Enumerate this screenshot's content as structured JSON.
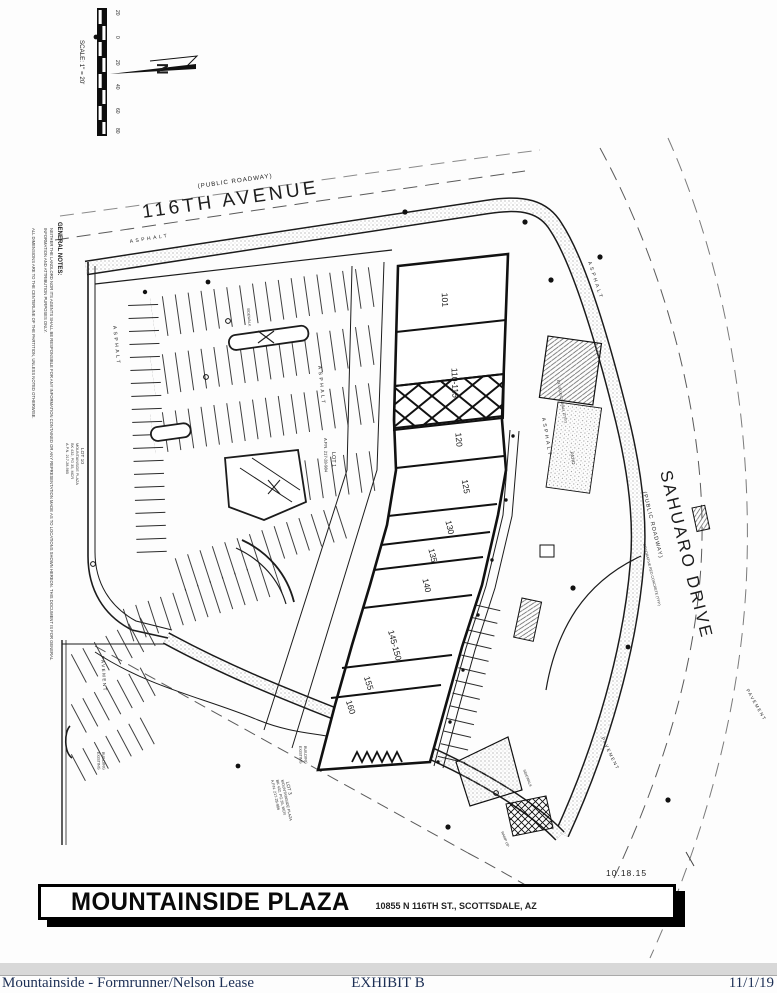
{
  "page": {
    "date_stamp": "10.18.15",
    "title_block": {
      "name": "MOUNTAINSIDE PLAZA",
      "address": "10855 N 116TH ST., SCOTTSDALE, AZ"
    },
    "footer": {
      "left": "Mountainside - Formrunner/Nelson Lease",
      "center": "EXHIBIT B",
      "right": "11/1/19"
    }
  },
  "plan": {
    "scale": {
      "label": "SCALE: 1\" = 20'",
      "ticks": [
        "20",
        "0",
        "20",
        "40",
        "60",
        "80"
      ]
    },
    "north_letter": "N",
    "notes": {
      "heading": "GENERAL NOTES:",
      "line1": "NEITHER THE LANDLORD NOR ITS AGENTS SHALL BE RESPONSIBLE FOR ANY INFORMATION CONTAINED OR ANY REPRESENTATION MADE AS TO LOCATIONS SHOWN HEREON. THIS DOCUMENT IS FOR GENERAL",
      "line2": "INFORMATION AND ATTRIBUTION PURPOSES ONLY.",
      "line3": "ALL DIMENSIONS ARE TO THE CENTERLINE OF THE PARTITION, UNLESS NOTED OTHERWISE."
    },
    "roads": {
      "top": {
        "name": "116TH AVENUE",
        "type": "(PUBLIC ROADWAY)"
      },
      "right": {
        "name": "SAHUARO DRIVE",
        "type": "(PUBLIC ROADWAY)"
      }
    },
    "labels": {
      "asphalt": "ASPHALT",
      "pavement": "PAVEMENT",
      "sidewalk": "SIDEWALK",
      "patio": "PATIO",
      "existing_1": "EXISTING",
      "existing_2": "BUILDING",
      "stucco": "EX. STUCCO WALL (TYP.)",
      "red_concrete": "DECORATIVE RED CONCRETE (TYP.)",
      "ramp": "RAMP UP"
    },
    "lots": {
      "lot1": [
        "LOT 1",
        "A.P.N. 217-28-984"
      ],
      "lot10": [
        "LOT 10",
        "MOUNTAINSIDE PLAZA",
        "BK 432, PG 35, MCR",
        "A.P.N. 217-28-985"
      ],
      "lot3": [
        "LOT 3",
        "MOUNTAINSIDE PLAZA",
        "BK 432, PG 35, MCR",
        "A.P.N. 217-28-986"
      ]
    },
    "units": [
      "101",
      "110-115",
      "120",
      "125",
      "130",
      "135",
      "140",
      "145-150",
      "155",
      "160"
    ]
  }
}
